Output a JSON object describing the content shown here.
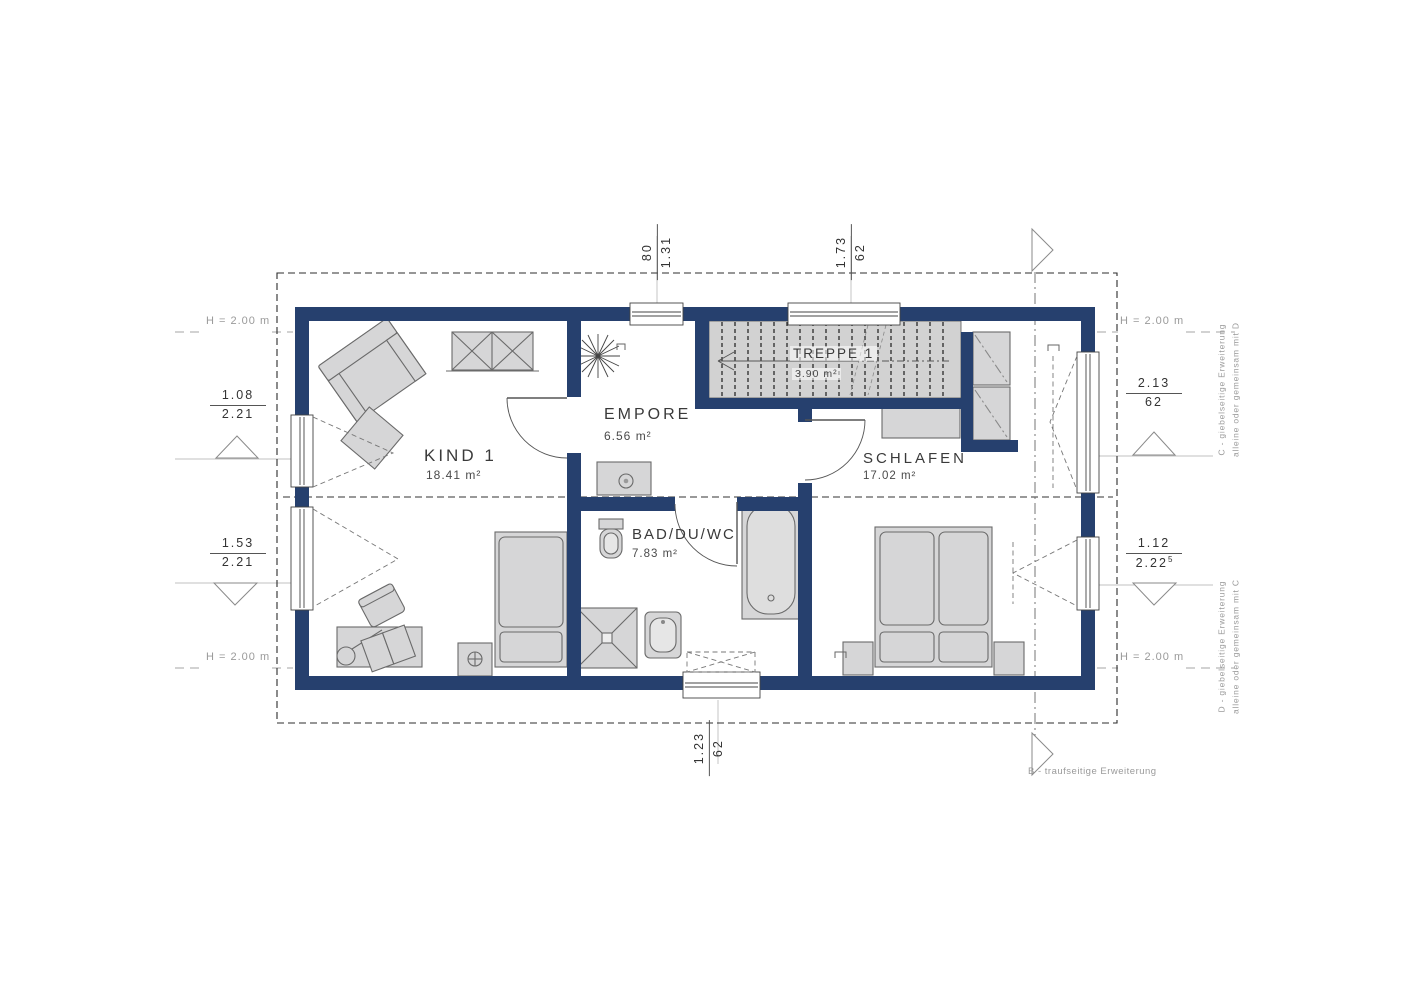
{
  "rooms": {
    "kind1": {
      "name": "KIND 1",
      "area": "18.41 m²"
    },
    "empore": {
      "name": "EMPORE",
      "area": "6.56 m²"
    },
    "bad": {
      "name": "BAD/DU/WC",
      "area": "7.83 m²"
    },
    "schlafen": {
      "name": "SCHLAFEN",
      "area": "17.02 m²"
    },
    "treppe": {
      "name": "TREPPE 1",
      "area": "3.90 m²"
    }
  },
  "dimensions": {
    "top": [
      {
        "num": "80",
        "den": "1.31"
      },
      {
        "num": "1.73",
        "den": "62"
      }
    ],
    "bottom": [
      {
        "num": "1.23",
        "den": "62"
      }
    ],
    "left": [
      {
        "num": "1.08",
        "den": "2.21"
      },
      {
        "num": "1.53",
        "den": "2.21"
      }
    ],
    "right": [
      {
        "num": "2.13",
        "den": "62"
      },
      {
        "num": "1.12",
        "den": "2.22",
        "sup": "5"
      }
    ]
  },
  "height_labels": {
    "top_left": "H = 2.00 m",
    "top_right": "H = 2.00 m",
    "bottom_left": "H = 2.00 m",
    "bottom_right": "H = 2.00 m"
  },
  "annotations": {
    "c_line1": "C - giebelseitige Erweiterung",
    "c_line2": "alleine oder gemeinsam mit D",
    "d_line1": "D - giebelseitige Erweiterung",
    "d_line2": "alleine oder gemeinsam mit C",
    "b": "B - traufseitige Erweiterung"
  },
  "colors": {
    "wall": "#26406e",
    "furniture": "#d6d6d7",
    "stair": "#d2d2d2",
    "line": "#3a3a3a"
  }
}
